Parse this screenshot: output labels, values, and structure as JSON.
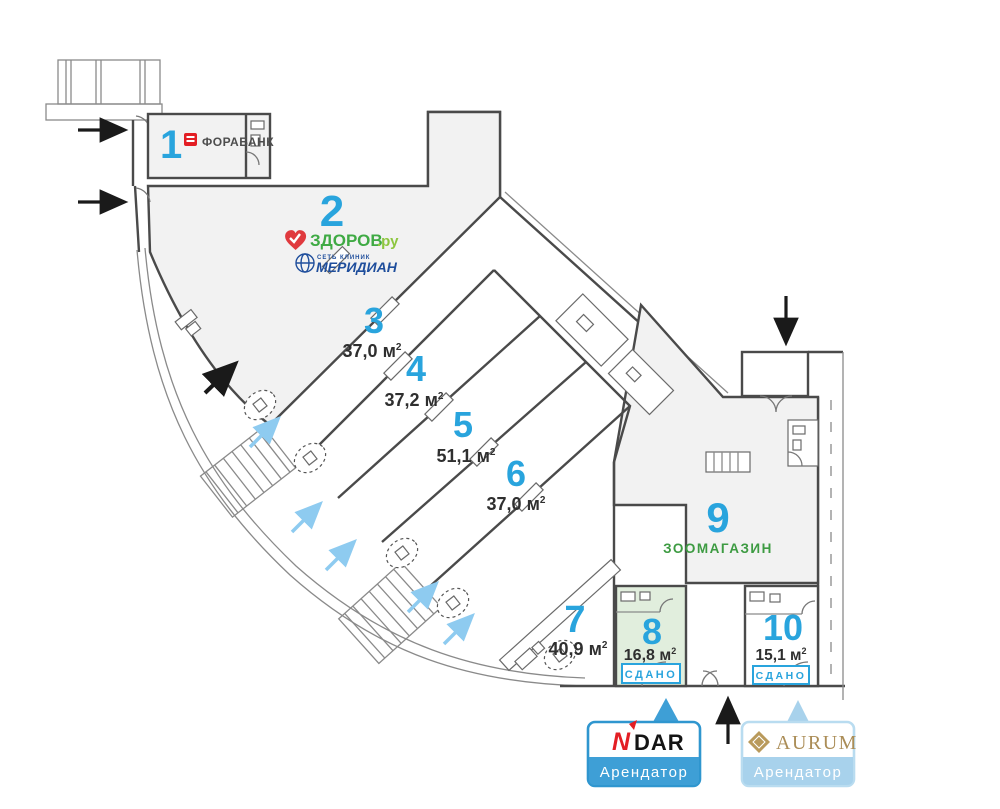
{
  "units": {
    "u1": {
      "number": "1",
      "tenant": "ФОРАБАНК"
    },
    "u2": {
      "number": "2",
      "tenant_heart": "ЗДОРОВ",
      "tenant_heart_suffix": ".ру",
      "tenant_clinic_small": "СЕТЬ КЛИНИК",
      "tenant_clinic": "МЕРИДИАН"
    },
    "u3": {
      "number": "3",
      "area": "37,0 м"
    },
    "u4": {
      "number": "4",
      "area": "37,2 м"
    },
    "u5": {
      "number": "5",
      "area": "51,1 м"
    },
    "u6": {
      "number": "6",
      "area": "37,0 м"
    },
    "u7": {
      "number": "7",
      "area": "40,9 м"
    },
    "u8": {
      "number": "8",
      "area": "16,8 м",
      "status": "СДАНО"
    },
    "u9": {
      "number": "9",
      "tenant": "ЗООМАГАЗИН"
    },
    "u10": {
      "number": "10",
      "area": "15,1 м",
      "status": "СДАНО"
    }
  },
  "sup": "2",
  "cards": {
    "ndar": {
      "brand_prefix": "N",
      "brand_suffix": "DAR",
      "label": "Арендатор"
    },
    "aurum": {
      "brand": "AURUM",
      "label": "Арендатор"
    }
  },
  "colors": {
    "unit_number": "#29a4dd",
    "area_text": "#2f2f2f",
    "rented_fill": "#e1eedd",
    "status_blue": "#29a4dd",
    "zoo_green": "#3d9b42",
    "zdorov_green": "#3faa44",
    "meridian_blue": "#1f4e9c",
    "forabank_red": "#e31e24",
    "ndar_bar": "#3e9fd6",
    "aurum_bar": "#a8d2ec",
    "aurum_gold": "#ab8d57",
    "entry_arrow_blue": "#8ecbf0"
  }
}
